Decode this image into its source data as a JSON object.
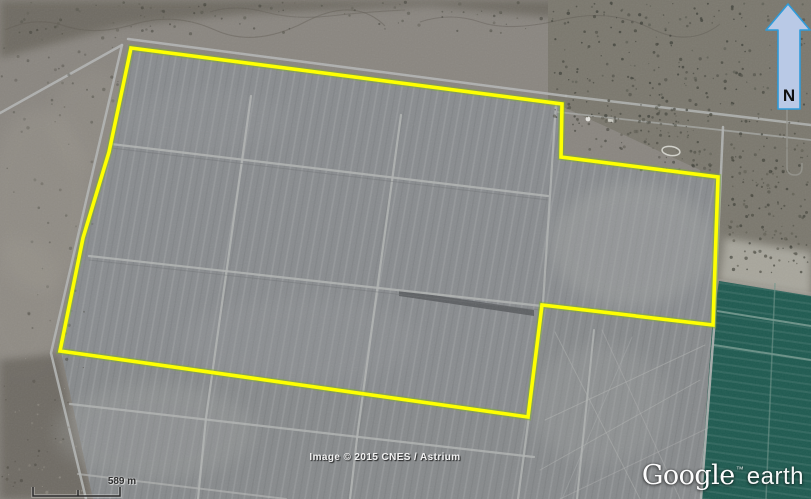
{
  "compass": {
    "label": "N"
  },
  "scale_bar": {
    "label": "589 m"
  },
  "attribution": {
    "text": "Image © 2015 CNES / Astrium"
  },
  "logo": {
    "primary": "Google",
    "trademark": "™",
    "secondary": "earth"
  },
  "overlay": {
    "boundary_color": "#feff01"
  },
  "palette": {
    "field_gray": "#898c8f",
    "lower_field_gray": "#878a8c",
    "scrub_base": "#8a8680",
    "scrub_dark": "#6e6a62",
    "scrub_right": "#7b786e",
    "irrigated_teal": "#1e5a50",
    "road_light": "#b3b5b4",
    "compass_fill": "#b9c9e6",
    "compass_stroke": "#2f9bd9"
  }
}
